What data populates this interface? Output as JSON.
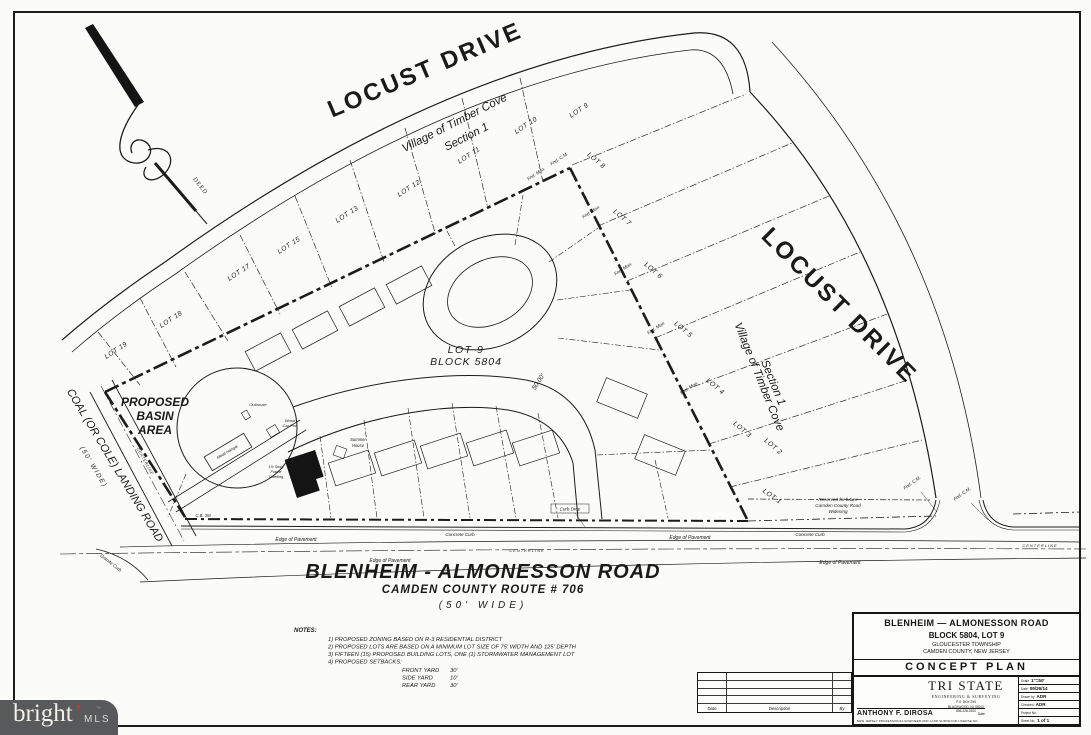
{
  "roads": {
    "locust_top": "LOCUST DRIVE",
    "locust_right": "LOCUST DRIVE",
    "coal_name": "COAL (OR COLE) LANDING ROAD",
    "coal_width": "(50' WIDE)",
    "coal_centerline": "CENTERLINE",
    "blenheim_name": "BLENHEIM - ALMONESSON ROAD",
    "blenheim_route": "CAMDEN COUNTY ROUTE # 706",
    "blenheim_width": "(50' WIDE)"
  },
  "subdivision": {
    "line1": "Village of Timber Cove",
    "line2": "Section 1"
  },
  "lots_top": [
    "LOT 9",
    "LOT 10",
    "LOT 11",
    "LOT 12",
    "LOT 13",
    "LOT 15",
    "LOT 17",
    "LOT 18",
    "LOT 19"
  ],
  "lots_right": [
    "LOT 8",
    "LOT 7",
    "LOT 6",
    "LOT 5",
    "LOT 4",
    "LOT 3",
    "LOT 2",
    "LOT 1"
  ],
  "subject": {
    "lot": "LOT 9",
    "block": "BLOCK 5804",
    "frontage_dim": "50.00'"
  },
  "basin": {
    "line1": "PROPOSED",
    "line2": "BASIN",
    "line3": "AREA"
  },
  "north_arrow": {
    "deed": "DEED"
  },
  "annotations": {
    "edge_of_pavement": "Edge of Pavement",
    "concrete_curb": "Concrete Curb",
    "centerline": "CENTERLINE",
    "granite_curb": "Granite Curb",
    "curb_drop": "Curb Drop",
    "catch_basin": "C.B. 3M",
    "found_monument": "Fnd. Mon.",
    "found_cm": "Fnd. C.M.",
    "reserved_line1": "Reserved for future",
    "reserved_line2": "Camden County Road",
    "reserved_line3": "Widening"
  },
  "structures": {
    "hangar": "Metal Hangar",
    "outhouse": "Outhouse",
    "carport_line1": "Wood",
    "carport_line2": "Car Port",
    "dwelling_line1": "1½ Story",
    "dwelling_line2": "Frame",
    "dwelling_line3": "Dwelling",
    "summer_line1": "Summer",
    "summer_line2": "House"
  },
  "notes": {
    "heading": "NOTES:",
    "items": [
      "1)  PROPOSED ZONING BASED ON R-3 RESIDENTIAL DISTRICT",
      "2)  PROPOSED LOTS ARE BASED ON A MINIMUM LOT SIZE OF 75' WIDTH AND 125' DEPTH",
      "3)  FIFTEEN (15) PROPOSED BUILDING LOTS, ONE (1) STORMWATER MANAGEMENT LOT",
      "4)  PROPOSED SETBACKS:"
    ],
    "setbacks": [
      {
        "label": "FRONT YARD",
        "value": "30'"
      },
      {
        "label": "SIDE YARD",
        "value": "10'"
      },
      {
        "label": "REAR YARD",
        "value": "30'"
      }
    ]
  },
  "title_block": {
    "project_line1": "BLENHEIM — ALMONESSON ROAD",
    "project_line2": "BLOCK 5804, LOT 9",
    "project_line3": "GLOUCESTER TOWNSHIP",
    "project_line4": "CAMDEN COUNTY, NEW JERSEY",
    "plan_type": "CONCEPT PLAN",
    "firm_name": "TRI STATE",
    "firm_tagline": "ENGINEERING & SURVEYING",
    "firm_addr1": "P.O. BOX 295",
    "firm_addr2": "BLACKWOOD, NJ 08012",
    "firm_addr3": "856-228-0100",
    "signer_name": "ANTHONY F. DIROSA",
    "signer_date_label": "Date",
    "license_note": "NEW JERSEY PROFESSIONAL ENGINEER AND LAND SURVEYOR LICENSE NO.",
    "info": {
      "scale_label": "Scale",
      "scale": "1\"=50'",
      "date_label": "Date",
      "date": "09/26/14",
      "drawn_label": "Drawn by",
      "drawn": "ADR",
      "checked_label": "Checked",
      "checked": "ADR",
      "project_label": "Project No.",
      "project": "",
      "sheet_label": "Sheet No.",
      "sheet": "1 of 1"
    },
    "revisions": {
      "date": "Date",
      "description": "Description",
      "by": "By"
    }
  },
  "watermark": {
    "brand": "bright",
    "tm": "™",
    "suffix": "MLS"
  }
}
